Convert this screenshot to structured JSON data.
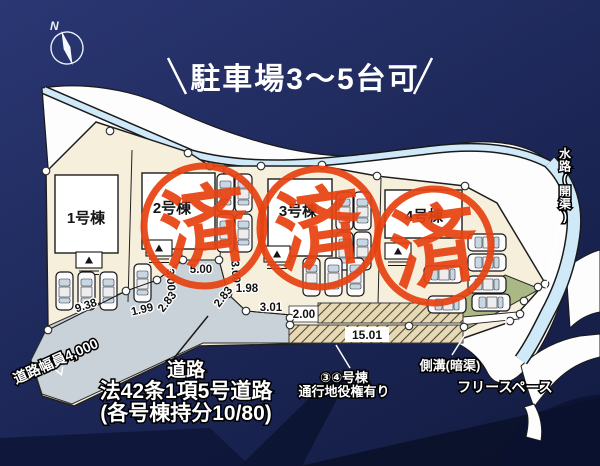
{
  "title": "駐車場3～5台可",
  "compass": {
    "north_label": "N"
  },
  "site": {
    "buildings": [
      {
        "label": "1号棟",
        "sold": false
      },
      {
        "label": "2号棟",
        "sold": true
      },
      {
        "label": "3号棟",
        "sold": true
      },
      {
        "label": "4号棟",
        "sold": true
      }
    ],
    "sold_stamp_text": "済",
    "measurements": [
      "9.38",
      "1.99",
      "2.83",
      "5.00",
      "3.00",
      "3.00",
      "2.83",
      "1.98",
      "3.01",
      "2.00",
      "15.01"
    ],
    "labels": {
      "road_width": "道路幅員4,000",
      "road_name_1": "道路",
      "road_name_2": "法42条1項5号道路",
      "road_name_3": "(各号棟持分10/80)",
      "easement_1": "③④号棟",
      "easement_2": "通行地役権有り",
      "gutter": "側溝(暗渠)",
      "free_space": "フリースペース",
      "waterway": "水路(開渠)"
    }
  },
  "colors": {
    "background": "#1c2758",
    "stamp_red": "#e74312",
    "plot_cream": "#f6efdc",
    "road_gray": "#c9d2d9",
    "water_blue": "#cfe9f8",
    "free_space_green": "#a9b884",
    "surround_white": "#fdfdfd"
  }
}
